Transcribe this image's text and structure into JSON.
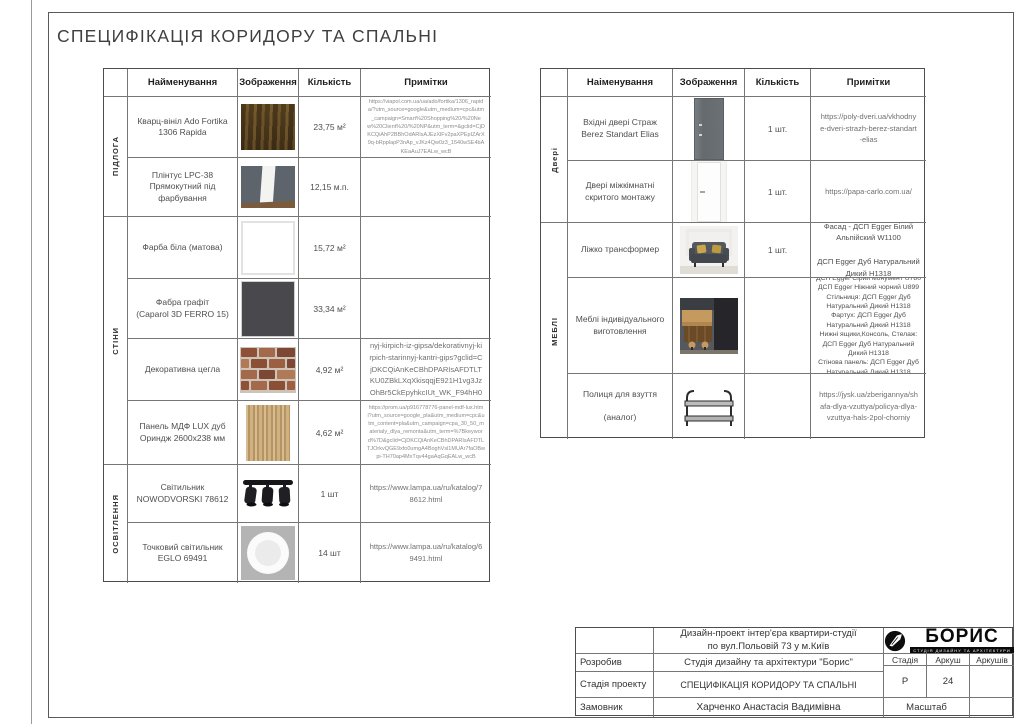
{
  "page_title": "СПЕЦИФІКАЦІЯ КОРИДОРУ ТА СПАЛЬНІ",
  "colors": {
    "table_border": "#767676",
    "outer_border": "#4d4d4d",
    "body_text": "#4e4e4e",
    "url_text": "#8d8d8d",
    "logo_black": "#0a0a0a",
    "pillow_yellow": "#c9a54b"
  },
  "tables": [
    {
      "headers": {
        "name": "Найменування",
        "image": "Зображення",
        "qty": "Кількість",
        "notes": "Примітки"
      },
      "categories": [
        {
          "label": "ПІДЛОГА"
        },
        {
          "label": "СТІНИ"
        },
        {
          "label": "ОСВІТЛЕННЯ"
        }
      ],
      "rows": [
        {
          "name": "Кварц-вініл Ado Fortika 1306 Rapida",
          "image_desc": "dark oak vinyl texture",
          "qty": "23,75 м²",
          "notes": "https://viapol.com.ua/ua/ado/fortika/1306_rapida/?utm_source=google&utm_medium=cpc&utm_campaign=Smart%20Shopping%20/%20New%20Client%20/%20NP&utm_term=&gclid=CjDKCQiAhP2BBhOdARIsAJEzXlFv2paXPEpIZArX9q-bRpplapP3nAp_vJKz4Qw0z3_1540wSE4bAKEaAuJ7EALw_wcB"
        },
        {
          "name": "Плінтус LPC-38 Прямокутний під фарбування",
          "image_desc": "white rectangular plinth on dark wall",
          "qty": "12,15 м.п.",
          "notes": ""
        },
        {
          "name": "Фарба біла (матова)",
          "image_desc": "white paint swatch",
          "qty": "15,72 м²",
          "notes": ""
        },
        {
          "name": "Фабра графіт\n(Caparol 3D FERRO 15)",
          "image_desc": "graphite paint swatch",
          "qty": "33,34 м²",
          "notes": ""
        },
        {
          "name": "Декоративна цегла",
          "image_desc": "decorative brick wall",
          "qty": "4,92 м²",
          "notes": "https://loft-stone.com/ru/dekorativnyj-kirpich-iz-gipsa/dekorativnyj-kirpich-starinnyj-kantri-gips?gclid=CjDKCQiAnKeCBhDPARIsAFDTLTKU0ZBkLXqXkisqqjE921H1vg3JzOhBr5CkEpyhkcIUt_WK_F94hH04aAnKqEALw_wcB"
        },
        {
          "name": "Панель МДФ LUX дуб Ориндж 2600х238 мм",
          "image_desc": "light oak MDF panel",
          "qty": "4,62 м²",
          "notes": "https://prom.ua/p916778776-panel-mdf-lux.html?utm_source=google_pla&utm_medium=cpc&utm_content=pla&utm_campaign=cpa_30_50_materialy_dlya_remonta&utm_term=%7Bkeyword%7D&gclid=CjDKCQiAnKeCBhDPARIsAFDTLTJOrkvQGE9xfo0umgA4BoghVsl1MUAr7faOBwpi-TH70ap4MxTqv44gaAqGqEALw_wcB"
        },
        {
          "name": "Світильник NOWODVORSKI 78612",
          "image_desc": "triple black spot lamp",
          "qty": "1 шт",
          "notes": "https://www.lampa.ua/ru/katalog/78612.html"
        },
        {
          "name": "Точковий світильник EGLO 69491",
          "image_desc": "round white recessed light",
          "qty": "14 шт",
          "notes": "https://www.lampa.ua/ru/katalog/69491.html"
        }
      ]
    },
    {
      "headers": {
        "name": "Наіменування",
        "image": "Зображення",
        "qty": "Кількість",
        "notes": "Примітки"
      },
      "categories": [
        {
          "label": "Двері"
        },
        {
          "label": "МЕБЛІ"
        }
      ],
      "rows": [
        {
          "name": "Вхідні двері Страж Berez Standart Elias",
          "image_desc": "dark grey entrance door",
          "qty": "1 шт.",
          "notes": "https://poly-dveri.ua/vkhodnye-dveri-strazh-berez-standart-elias"
        },
        {
          "name": "Двері міжкімнатні скритого монтажу",
          "image_desc": "white concealed interior door",
          "qty": "1 шт.",
          "notes": "https://papa-carlo.com.ua/"
        },
        {
          "name": "Ліжко трансформер",
          "image_desc": "grey sofa-bed with yellow pillows",
          "qty": "1 шт.",
          "notes": "Фасад - ДСП Egger Білий Альпійский W1100\n\nДСП Egger Дуб Натуральний Дикий H1318"
        },
        {
          "name": "Меблі індивідуального виготовлення",
          "image_desc": "dark kitchen with wood island",
          "qty": "",
          "notes": "ДСП Egger Сірий монумент U780\nДСП Egger Ніжний чорний U899\nСтільниця: ДСП Egger Дуб Натуральний Дикий H1318\nФартух: ДСП Egger Дуб Натуральний Дикий H1318\nНижні ящики,Консоль, Стелаж: ДСП Egger Дуб Натуральний Дикий H1318\nСтінова панель: ДСП Egger Дуб Натуральний Дикий H1318"
        },
        {
          "name": "Полиця для взуття\n\n(аналог)",
          "image_desc": "black two-tier shoe rack",
          "qty": "",
          "notes": "https://jysk.ua/zberigannya/shafa-dlya-vzuttya/policya-dlya-vzuttya-hals-2pol-chorniy"
        }
      ]
    }
  ],
  "title_block": {
    "project": "Дизайн-проект інтер'єра квартири-студії\nпо вул.Польовій 73 у м.Київ",
    "rows": [
      {
        "label": "Розробив",
        "value": "Студія дизайну та архітектури \"Борис\""
      },
      {
        "label": "Стадія проекту",
        "value": "СПЕЦИФІКАЦІЯ КОРИДОРУ ТА СПАЛЬНІ"
      },
      {
        "label": "Замовник",
        "value": "Харченко Анастасія Вадимівна"
      }
    ],
    "meta": {
      "stage_label": "Стадія",
      "sheet_label": "Аркуш",
      "sheets_label": "Аркушів",
      "stage": "Р",
      "sheet": "24",
      "scale_label": "Масштаб"
    },
    "logo": {
      "name": "БОРИС",
      "tagline": "СТУДІЯ ДИЗАЙНУ ТА АРХІТЕКТУРИ"
    }
  }
}
